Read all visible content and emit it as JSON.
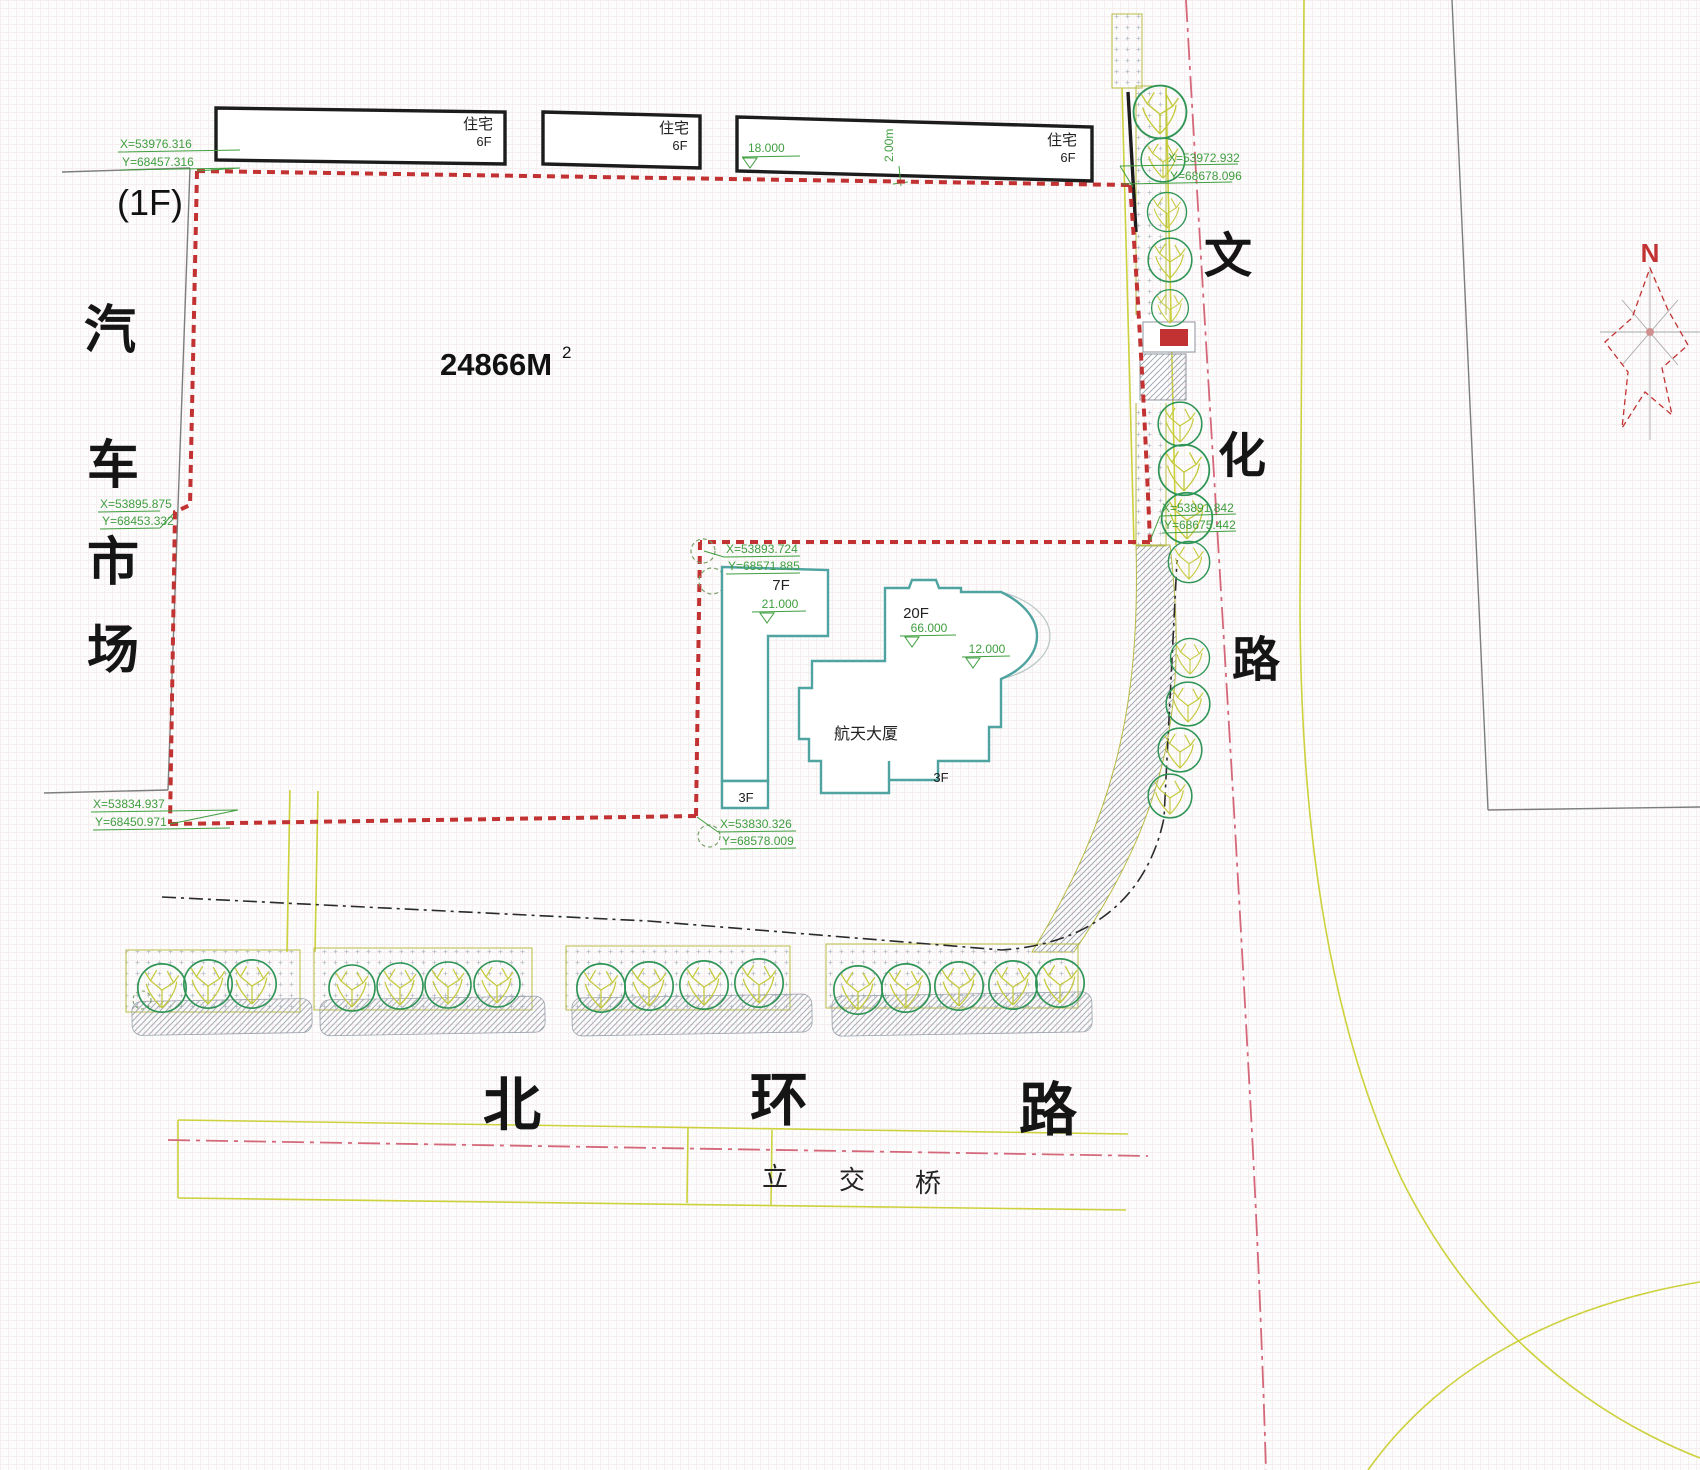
{
  "drawing": {
    "type": "site-plan",
    "area_label": "24866M",
    "area_exponent": "2",
    "north_label": "N"
  },
  "parcels": {
    "left_floor_note": "(1F)",
    "auto_market_chars": [
      "汽",
      "车",
      "市",
      "场"
    ]
  },
  "roads": {
    "wenhua_chars": [
      "文",
      "化",
      "路"
    ],
    "beihuan_chars": [
      "北",
      "环",
      "路"
    ],
    "overpass_chars": [
      "立",
      "交",
      "桥"
    ]
  },
  "buildings": {
    "residential": [
      {
        "label": "住宅",
        "floors": "6F"
      },
      {
        "label": "住宅",
        "floors": "6F"
      },
      {
        "label": "住宅",
        "floors": "6F"
      }
    ],
    "tower_name": "航天大厦",
    "wing_7f": "7F",
    "tower_20f": "20F",
    "annex_3f_left": "3F",
    "annex_3f_right": "3F"
  },
  "elevations": {
    "residential_top": "18.000",
    "setback_dim": "2.00m",
    "wing7_top": "21.000",
    "tower_top": "66.000",
    "podium_top": "12.000"
  },
  "coordinates": [
    {
      "x": "X=53976.316",
      "y": "Y=68457.316"
    },
    {
      "x": "X=53895.875",
      "y": "Y=68453.332"
    },
    {
      "x": "X=53834.937",
      "y": "Y=68450.971"
    },
    {
      "x": "X=53893.724",
      "y": "Y=68571.885"
    },
    {
      "x": "X=53830.326",
      "y": "Y=68578.009"
    },
    {
      "x": "X=53972.932",
      "y": "Y=68678.096"
    },
    {
      "x": "X=53891.842",
      "y": "Y=68675.442"
    }
  ],
  "colors": {
    "boundary_red": "#c23232",
    "tower_teal": "#4fa3a0",
    "annotation_green": "#3f9e3f",
    "road_yellow": "#ccd13c",
    "centerline_pink": "#d4687a",
    "tree_green": "#2f9556",
    "tree_branch": "#c3c93a",
    "building_black": "#1c1c1c"
  }
}
